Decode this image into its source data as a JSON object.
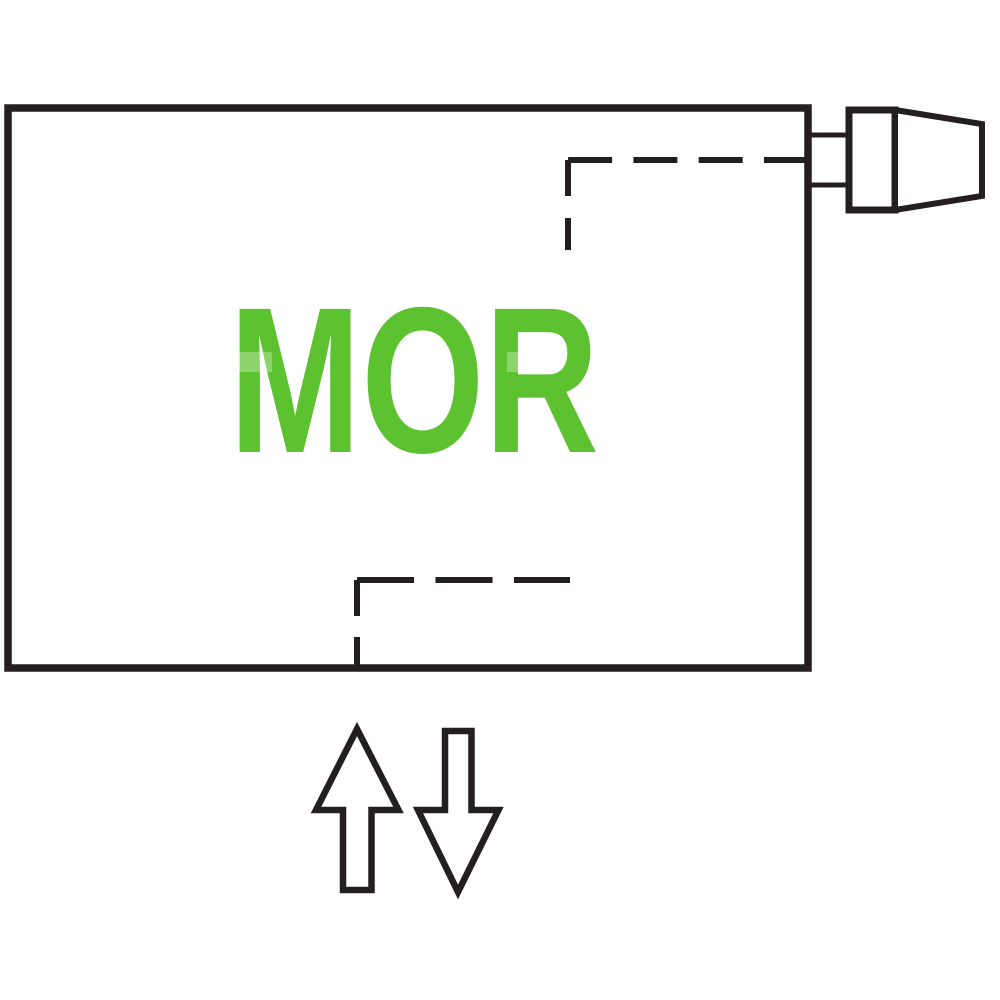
{
  "diagram": {
    "model_label": "MOR",
    "icons": {
      "valve": "thermostatic-valve-icon",
      "flow_up": "arrow-up-icon",
      "flow_down": "arrow-down-icon"
    }
  },
  "colors": {
    "line": "#231f20",
    "accent_green": "#5cc22f",
    "background": "#ffffff"
  }
}
